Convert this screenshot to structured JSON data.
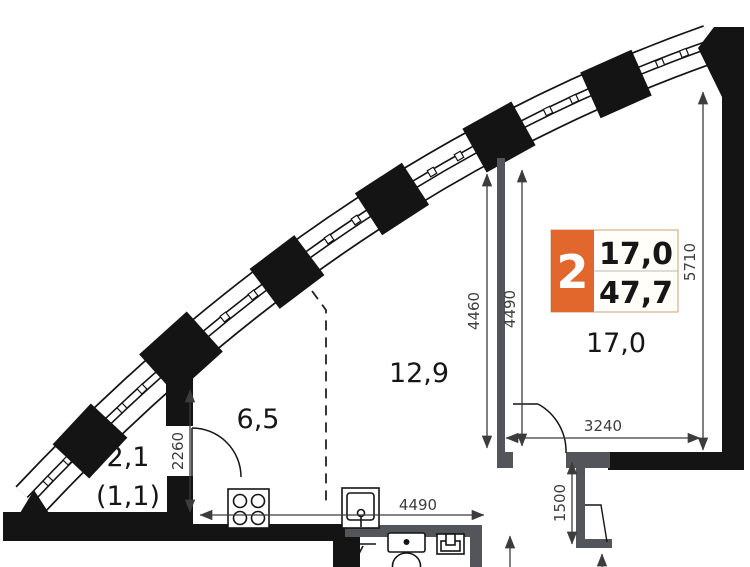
{
  "badge": {
    "rooms_count": "2",
    "value_top": "17,0",
    "value_bottom": "47,7"
  },
  "rooms": {
    "loggia": {
      "area": "2,1",
      "area_reduced": "(1,1)"
    },
    "kitchen": {
      "area": "6,5"
    },
    "living": {
      "area": "12,9"
    },
    "bedroom": {
      "area": "17,0"
    }
  },
  "dimensions_mm": {
    "loggia_depth": "2260",
    "kitchen_width": "4490",
    "living_height": "4460",
    "bedroom_height_inner": "4490",
    "bedroom_height_outer": "5710",
    "bedroom_width": "3240",
    "niche_depth": "1500"
  },
  "colors": {
    "accent_orange": "#e2672d",
    "wall_black": "#141414",
    "partition_gray": "#54555a"
  }
}
